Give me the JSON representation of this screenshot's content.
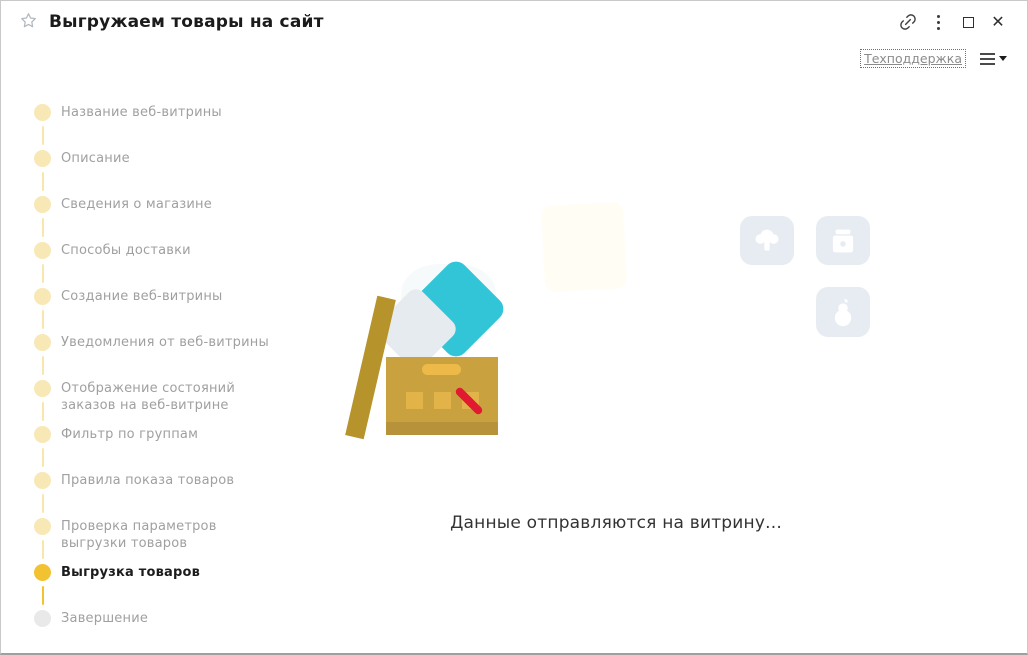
{
  "window": {
    "title": "Выгружаем товары на сайт",
    "controls": {
      "favorite": "star-icon",
      "link": "link-icon",
      "more": "more-vert-icon",
      "maximize": "maximize-icon",
      "close": "close-icon",
      "close_glyph": "✕"
    }
  },
  "toolbar": {
    "support_link_label": "Техподдержка",
    "menu_icon": "hamburger-menu-icon"
  },
  "stepper": {
    "steps": [
      {
        "label": "Название веб-витрины",
        "state": "done"
      },
      {
        "label": "Описание",
        "state": "done"
      },
      {
        "label": "Сведения о магазине",
        "state": "done"
      },
      {
        "label": "Способы доставки",
        "state": "done"
      },
      {
        "label": "Создание веб-витрины",
        "state": "done"
      },
      {
        "label": "Уведомления от веб-витрины",
        "state": "done"
      },
      {
        "label": "Отображение состояний\nзаказов на веб-витрине",
        "state": "done"
      },
      {
        "label": "Фильтр по группам",
        "state": "done"
      },
      {
        "label": "Правила показа товаров",
        "state": "done"
      },
      {
        "label": "Проверка параметров\nвыгрузки товаров",
        "state": "done"
      },
      {
        "label": "Выгрузка товаров",
        "state": "active"
      },
      {
        "label": "Завершение",
        "state": "pending"
      }
    ]
  },
  "main": {
    "status_text": "Данные отправляются на витрину...",
    "illustration": {
      "name": "open-box-illustration",
      "background_icons": [
        "broccoli-icon",
        "jar-icon",
        "pear-icon"
      ]
    }
  },
  "colors": {
    "step_done": "#f8e8b5",
    "step_active": "#f3c230",
    "step_pending": "#e9e9e9",
    "step_text": "#a0a0a0",
    "step_text_active": "#1c1c1c",
    "box_gold": "#c9a23f",
    "box_lid": "#b6932b",
    "teal": "#31c5d7",
    "red_mark": "#e11931",
    "faded_tile_bg": "#e7ecf2"
  }
}
